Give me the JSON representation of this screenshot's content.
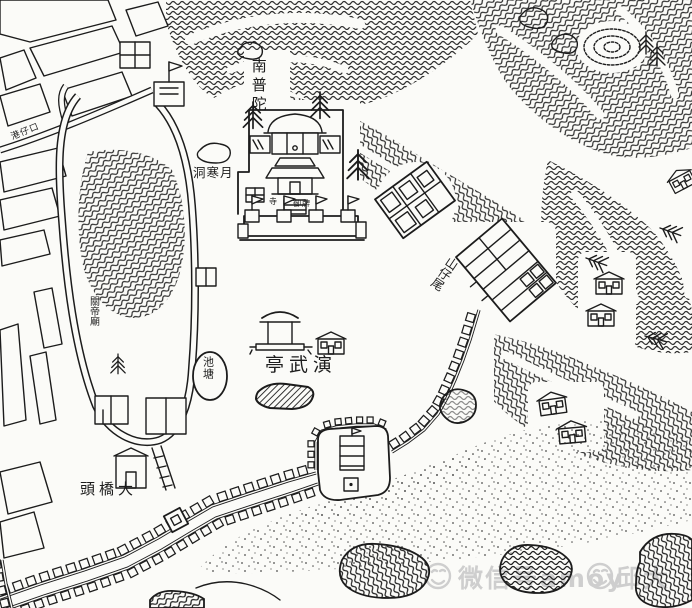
{
  "colors": {
    "paper": "#fbfbf8",
    "ink": "#1c1c1c",
    "watermark_gray": "#c7c7c7"
  },
  "labels": {
    "temple_name": "南普陀",
    "cave": "洞寒月",
    "pond": "池塘",
    "parade_pavilion": "亭武演",
    "bridge_head": "頭橋大",
    "hill_tail": "山仔尾",
    "temple_small_left": "寺",
    "temple_small_right": "御牌",
    "street": "港仔口",
    "shrine": "關帝廟"
  },
  "watermark": {
    "app_label": "微信号",
    "account": "amoy",
    "author": "邱大",
    "face_icon": "smiley-face-icon"
  }
}
